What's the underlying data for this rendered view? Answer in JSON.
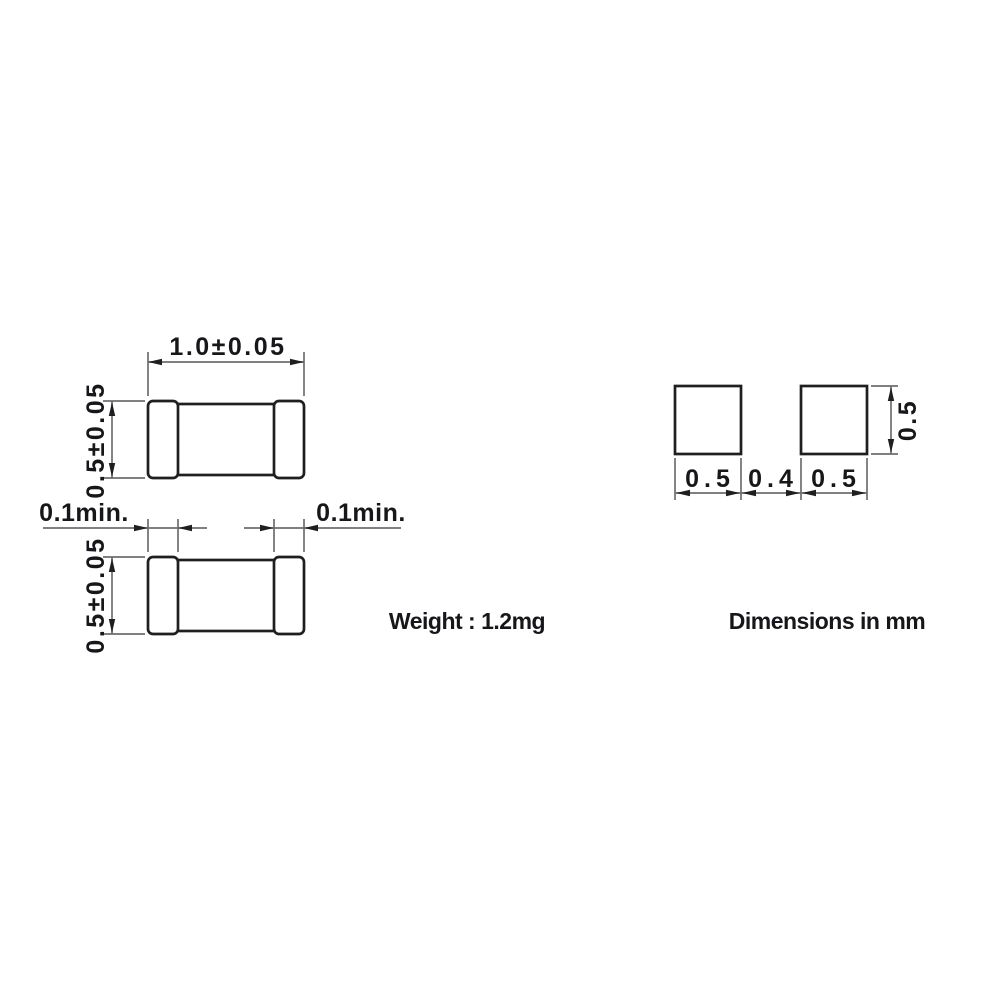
{
  "views": {
    "top": {
      "length_label": "1.0±0.05",
      "height_label": "0.5±0.05"
    },
    "bottom": {
      "height_label": "0.5±0.05",
      "terminal_left_label": "0.1min.",
      "terminal_right_label": "0.1min."
    }
  },
  "land_pattern": {
    "bottom_labels": [
      "0.5",
      "0.4",
      "0.5"
    ],
    "pad_height_label": "0.5"
  },
  "notes": {
    "weight": "Weight : 1.2mg",
    "units": "Dimensions in mm"
  },
  "colors": {
    "background": "#ffffff",
    "outline": "#1f1f1f",
    "dimension_line": "#6e6e6e",
    "text": "#17171b"
  }
}
